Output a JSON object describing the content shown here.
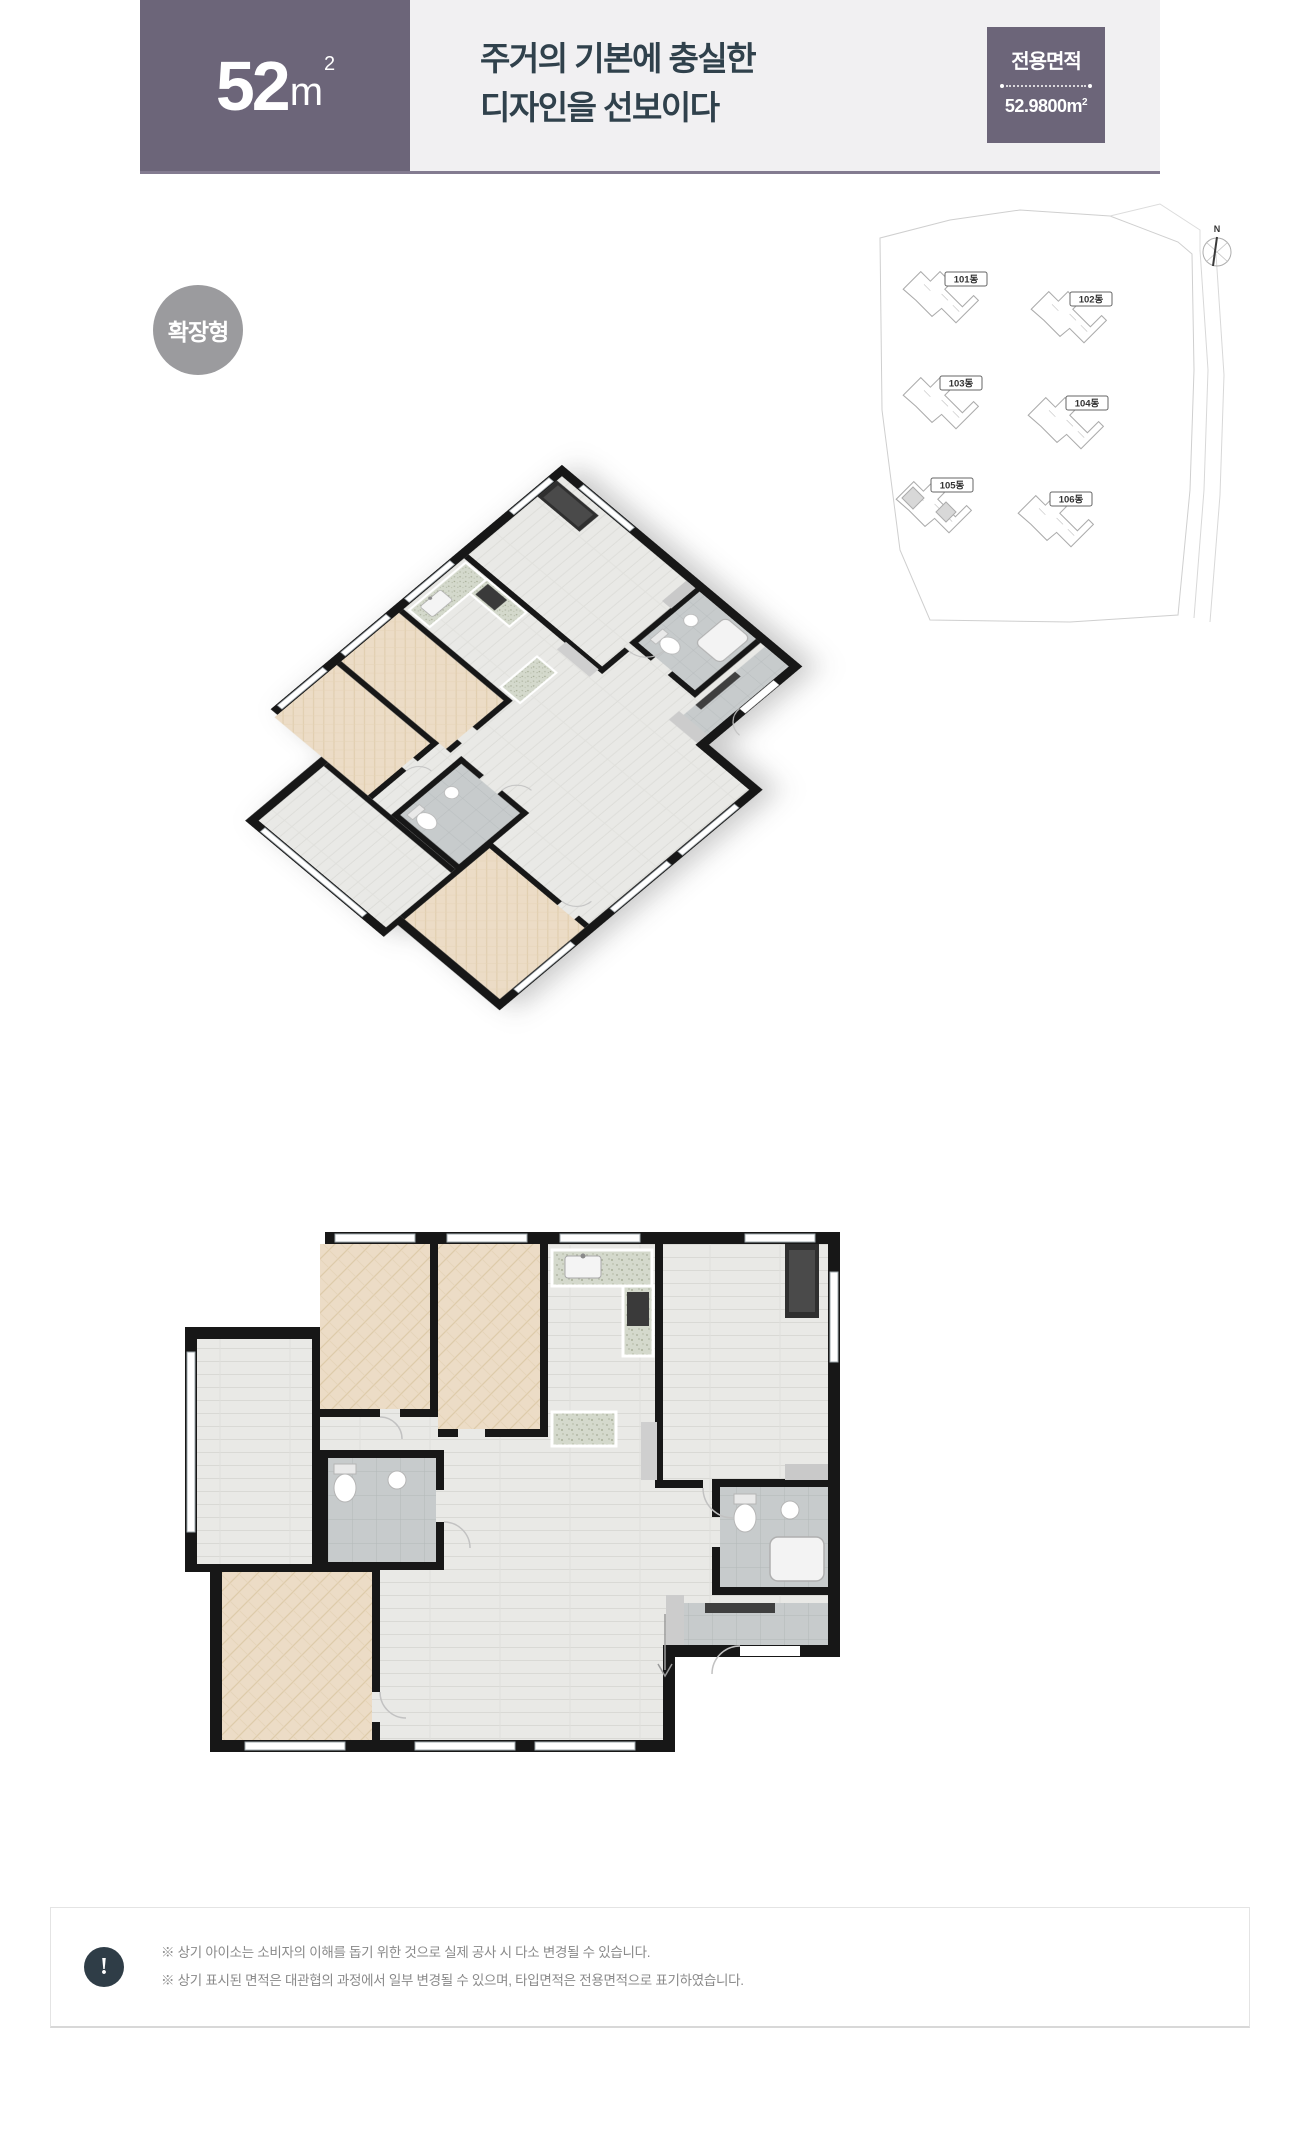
{
  "header": {
    "size_number": "52",
    "size_unit_base": "m",
    "size_unit_sup": "2",
    "title_line1": "주거의 기본에 충실한",
    "title_line2": "디자인을 선보이다",
    "area_label": "전용면적",
    "area_value": "52.9800",
    "area_unit_base": "m",
    "area_unit_sup": "2"
  },
  "badge": {
    "label": "확장형"
  },
  "site_plan": {
    "compass": "N",
    "buildings": [
      {
        "label": "101동"
      },
      {
        "label": "102동"
      },
      {
        "label": "103동"
      },
      {
        "label": "104동"
      },
      {
        "label": "105동"
      },
      {
        "label": "106동"
      }
    ]
  },
  "colors": {
    "accent_purple": "#6c6579",
    "header_band": "#f1f0f2",
    "title_text": "#30414c",
    "badge_gray": "#9b9b9e",
    "footer_icon_bg": "#2f3d47",
    "wall_black": "#171717"
  },
  "footer": {
    "icon_glyph": "!",
    "notes": [
      "※ 상기 아이소는 소비자의 이해를 돕기 위한 것으로 실제 공사 시 다소 변경될 수 있습니다.",
      "※ 상기 표시된 면적은 대관협의 과정에서 일부 변경될 수 있으며, 타입면적은 전용면적으로 표기하였습니다."
    ]
  }
}
